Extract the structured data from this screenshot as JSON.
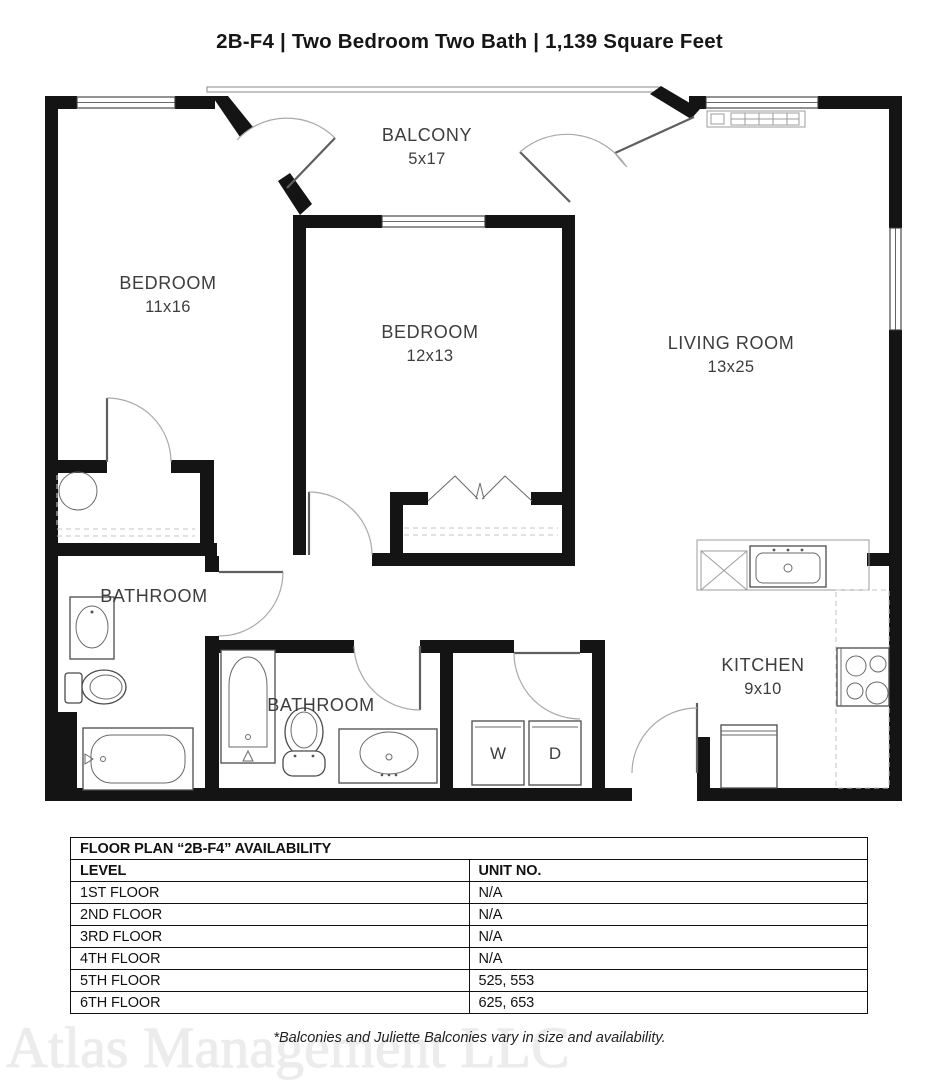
{
  "title": "2B-F4 | Two Bedroom Two Bath | 1,139 Square Feet",
  "colors": {
    "walls": "#141414",
    "label_text": "#3d3d3d"
  },
  "plan": {
    "rooms": [
      {
        "id": "balcony",
        "label": "BALCONY",
        "dim": "5x17"
      },
      {
        "id": "bedroom1",
        "label": "BEDROOM",
        "dim": "11x16"
      },
      {
        "id": "bedroom2",
        "label": "BEDROOM",
        "dim": "12x13"
      },
      {
        "id": "living",
        "label": "LIVING ROOM",
        "dim": "13x25"
      },
      {
        "id": "bathroom1",
        "label": "BATHROOM",
        "dim": ""
      },
      {
        "id": "bathroom2",
        "label": "BATHROOM",
        "dim": ""
      },
      {
        "id": "kitchen",
        "label": "KITCHEN",
        "dim": "9x10"
      }
    ],
    "appliances": {
      "washer": "W",
      "dryer": "D"
    }
  },
  "availability": {
    "title": "FLOOR PLAN “2B-F4” AVAILABILITY",
    "columns": {
      "level": "LEVEL",
      "unit": "UNIT NO."
    },
    "rows": [
      {
        "level": "1ST FLOOR",
        "units": "N/A"
      },
      {
        "level": "2ND FLOOR",
        "units": "N/A"
      },
      {
        "level": "3RD FLOOR",
        "units": "N/A"
      },
      {
        "level": "4TH FLOOR",
        "units": "N/A"
      },
      {
        "level": "5TH FLOOR",
        "units": "525, 553"
      },
      {
        "level": "6TH FLOOR",
        "units": "625, 653"
      }
    ]
  },
  "footer": {
    "watermark": "Atlas Management LLC",
    "note": "*Balconies and Juliette Balconies vary in size and availability."
  }
}
